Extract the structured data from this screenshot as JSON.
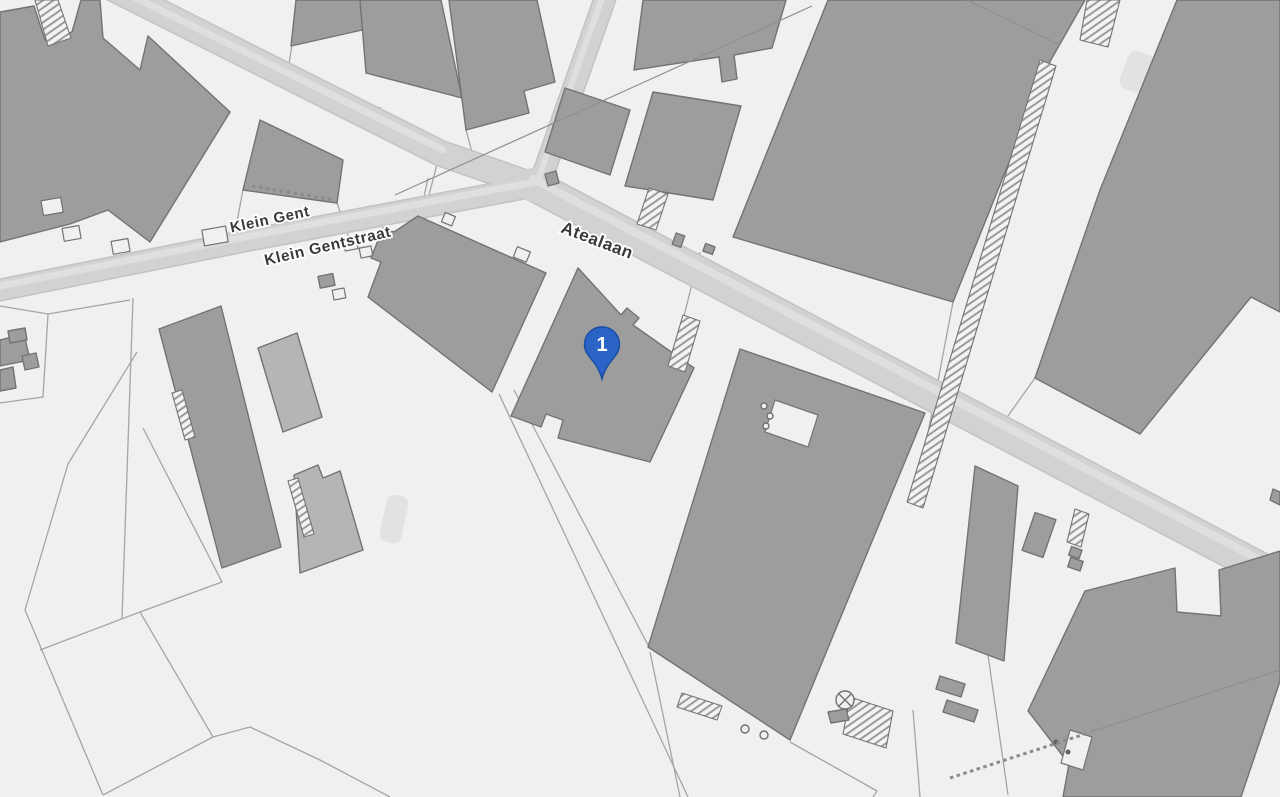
{
  "map": {
    "labels": {
      "street_1": "Klein Gent",
      "street_2": "Klein Gentstraat",
      "street_3": "Atealaan"
    },
    "marker": {
      "label": "1"
    },
    "colors": {
      "background": "#f0f0f0",
      "building": "#9d9d9d",
      "building_light": "#b5b5b5",
      "building_stroke": "#737373",
      "road": "#d2d2d2",
      "road_casing": "#c3c3c3",
      "road_stripe": "#dfdfdf",
      "parcel_line": "#a5a5a5",
      "label_text": "#3a3a3a",
      "marker_fill": "#2b64c7",
      "marker_stroke": "#1d4fa3",
      "marker_text": "#ffffff"
    }
  }
}
